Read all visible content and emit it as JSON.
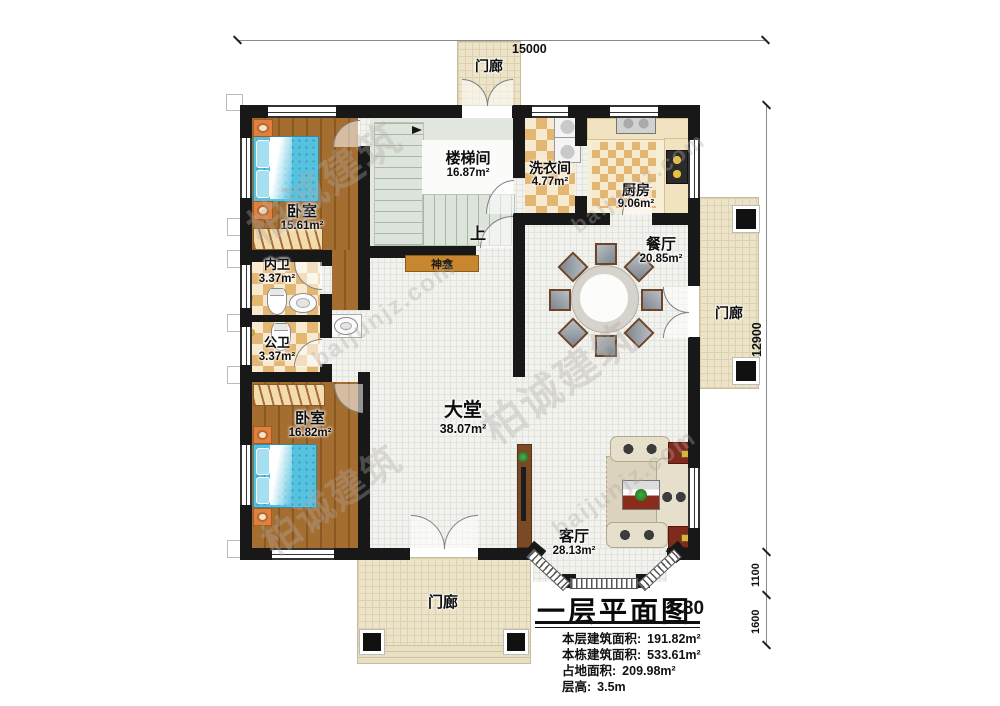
{
  "rooms": {
    "porch_top": {
      "name": "门廊"
    },
    "porch_right": {
      "name": "门廊"
    },
    "porch_bottom": {
      "name": "门廊"
    },
    "bedroom1": {
      "name": "卧室",
      "area": "15.61m²"
    },
    "stairwell": {
      "name": "楼梯间",
      "area": "16.87m²"
    },
    "laundry": {
      "name": "洗衣间",
      "area": "4.77m²"
    },
    "kitchen": {
      "name": "厨房",
      "area": "9.06m²"
    },
    "bath_ensuite": {
      "name": "内卫",
      "area": "3.37m²"
    },
    "bath_public": {
      "name": "公卫",
      "area": "3.37m²"
    },
    "dining": {
      "name": "餐厅",
      "area": "20.85m²"
    },
    "bedroom2": {
      "name": "卧室",
      "area": "16.82m²"
    },
    "hall": {
      "name": "大堂",
      "area": "38.07m²"
    },
    "living": {
      "name": "客厅",
      "area": "28.13m²"
    }
  },
  "labels": {
    "up": "上",
    "shrine": "神龛"
  },
  "dimensions": {
    "width_top": "15000",
    "height_right": "12900",
    "bay_offset": "1100",
    "porch_offset": "1600"
  },
  "title_block": {
    "title": "一层平面图",
    "scale": "1:80",
    "lines": [
      {
        "label": "本层建筑面积:",
        "value": "191.82m²"
      },
      {
        "label": "本栋建筑面积:",
        "value": "533.61m²"
      },
      {
        "label": "占地面积:",
        "value": "209.98m²"
      },
      {
        "label": "层高:",
        "value": "3.5m"
      }
    ]
  },
  "watermark": {
    "brand": "柏诚建筑",
    "site": "baijunjz.com"
  },
  "colors": {
    "wall": "#181818",
    "wood": "#9c662a",
    "checker": "#e3b671",
    "porch": "#ece3c8",
    "bed": "#55c2e0",
    "accent_red": "#7e2a1c"
  }
}
